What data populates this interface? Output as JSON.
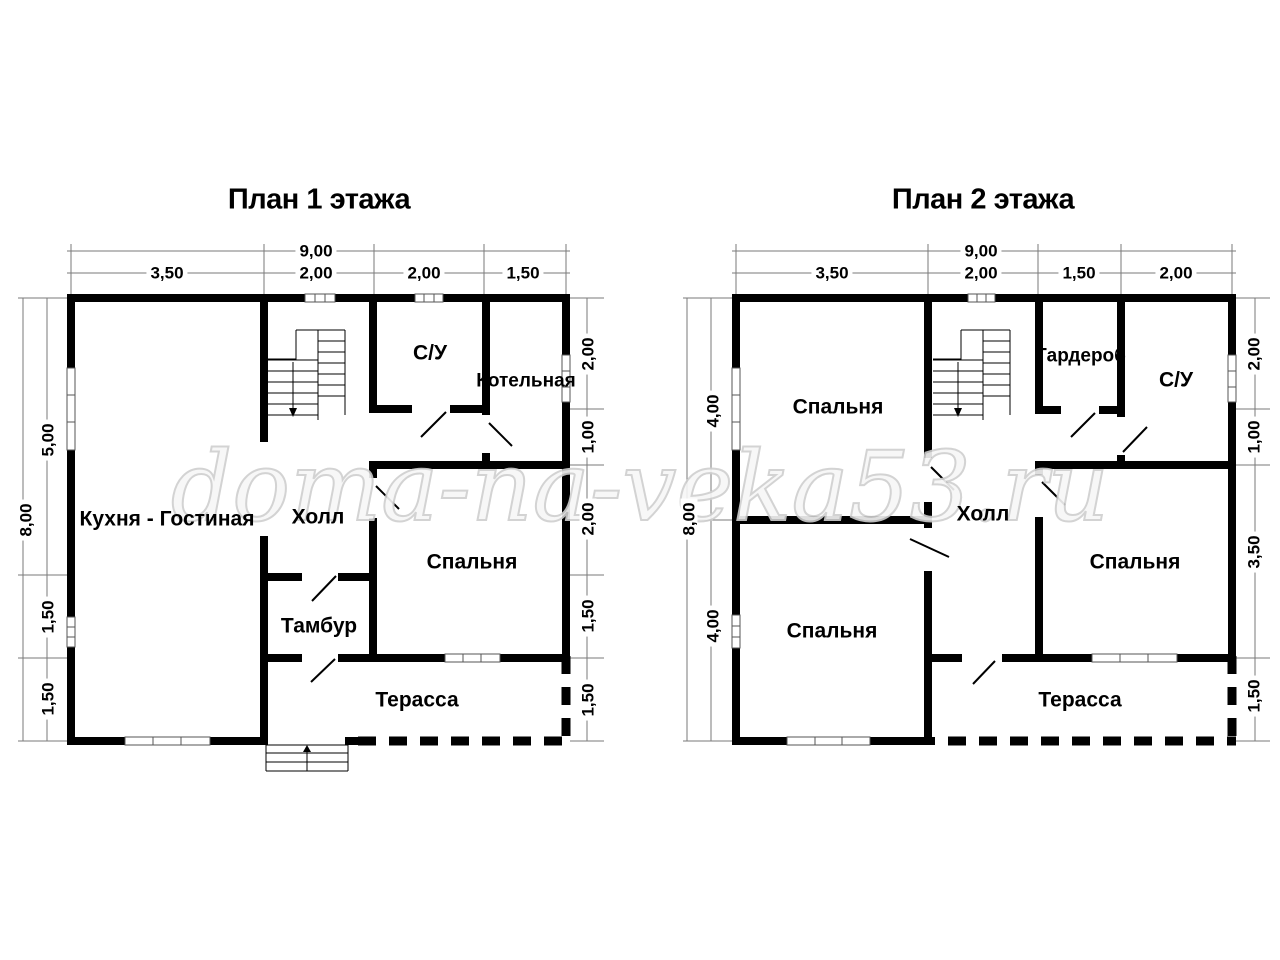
{
  "watermark": "doma-na-veka53.ru",
  "colors": {
    "wall": "#000000",
    "dim_line": "#7a7a7a",
    "window_frame": "#555555",
    "watermark_outline": "#cfcfcf",
    "background": "#ffffff"
  },
  "plans": [
    {
      "title": "План 1 этажа",
      "dims": {
        "top_total": "9,00",
        "top_segments": [
          "3,50",
          "2,00",
          "2,00",
          "1,50"
        ],
        "left_total": "8,00",
        "left_segments": [
          "5,00",
          "1,50",
          "1,50"
        ],
        "right_segments": [
          "2,00",
          "1,00",
          "2,00",
          "1,50",
          "1,50"
        ]
      },
      "rooms": {
        "kitchen_living": "Кухня - Гостиная",
        "hall": "Холл",
        "wc": "С/У",
        "boiler": "Котельная",
        "bedroom": "Спальня",
        "vestibule": "Тамбур",
        "terrace": "Терасса"
      }
    },
    {
      "title": "План 2 этажа",
      "dims": {
        "top_total": "9,00",
        "top_segments": [
          "3,50",
          "2,00",
          "1,50",
          "2,00"
        ],
        "left_total": "8,00",
        "left_segments": [
          "4,00",
          "4,00"
        ],
        "right_segments": [
          "2,00",
          "1,00",
          "3,50",
          "1,50"
        ]
      },
      "rooms": {
        "bedroom_top": "Спальня",
        "wardrobe": "Гардероб",
        "wc": "С/У",
        "hall": "Холл",
        "bedroom_right": "Спальня",
        "bedroom_bottom": "Спальня",
        "terrace": "Терасса"
      }
    }
  ]
}
